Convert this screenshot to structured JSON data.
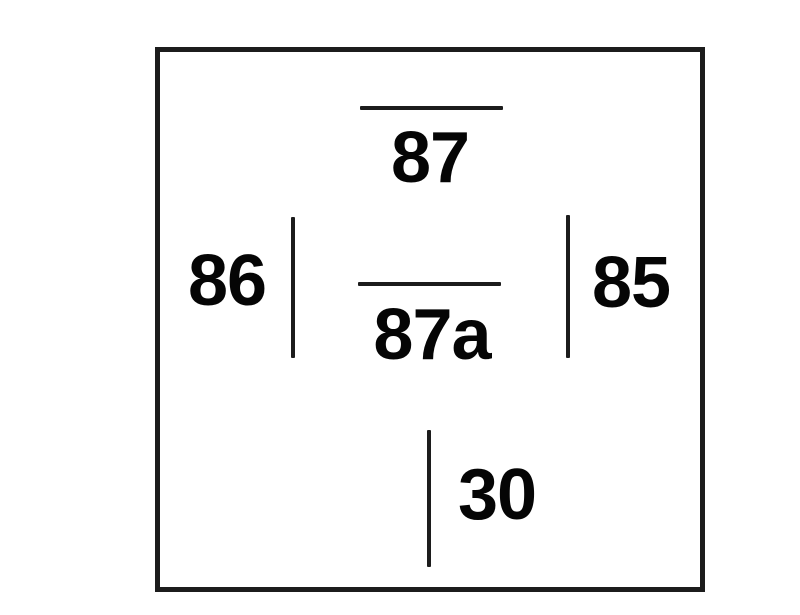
{
  "diagram": {
    "type": "relay-socket-pinout",
    "pins": [
      {
        "label": "87"
      },
      {
        "label": "87a"
      },
      {
        "label": "86"
      },
      {
        "label": "85"
      },
      {
        "label": "30"
      }
    ],
    "colors": {
      "line": "#1c1c1c",
      "text": "#050505",
      "background": "#ffffff"
    }
  }
}
